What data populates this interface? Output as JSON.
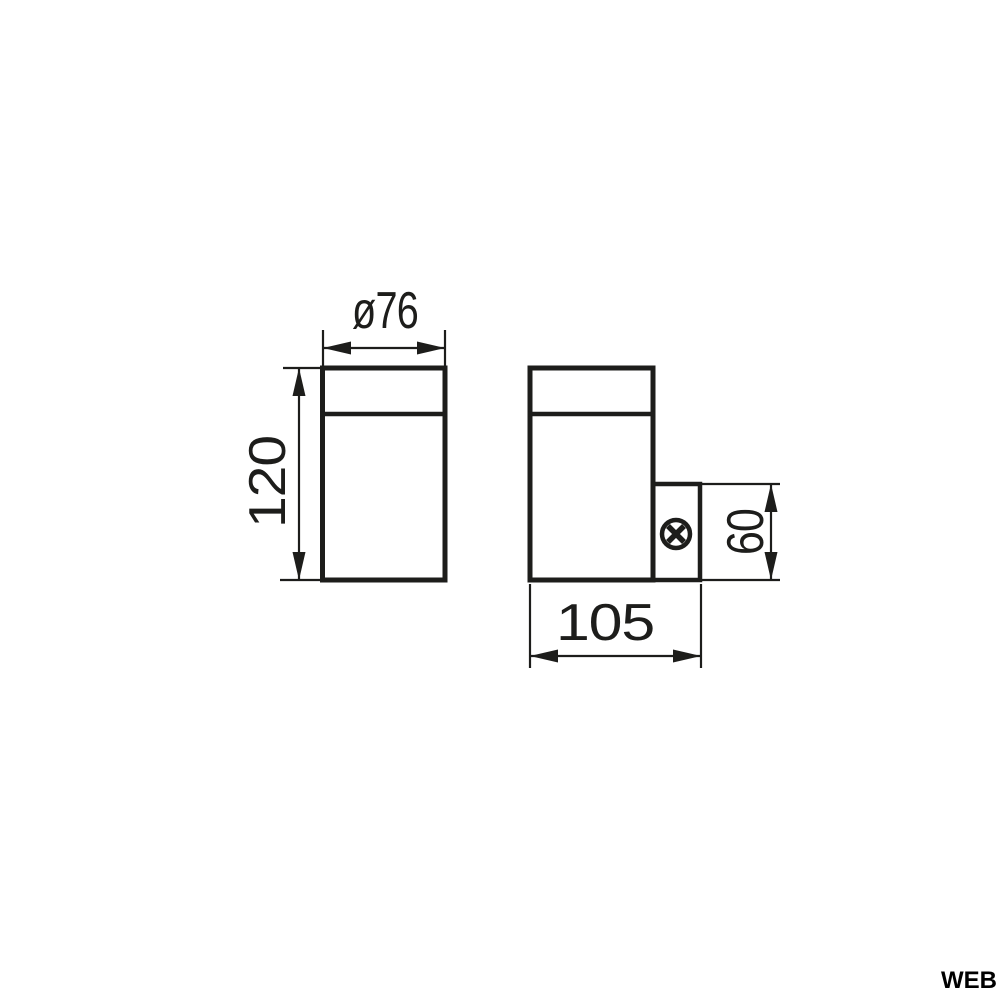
{
  "page": {
    "background_color": "#ffffff",
    "line_color": "#1d1d1b",
    "watermark": "WEB"
  },
  "drawing": {
    "front_view": {
      "diameter_label": "ø76",
      "height_label": "120"
    },
    "side_view": {
      "depth_label": "105",
      "bracket_height_label": "60",
      "screw_icon": "screw-head-icon"
    }
  }
}
